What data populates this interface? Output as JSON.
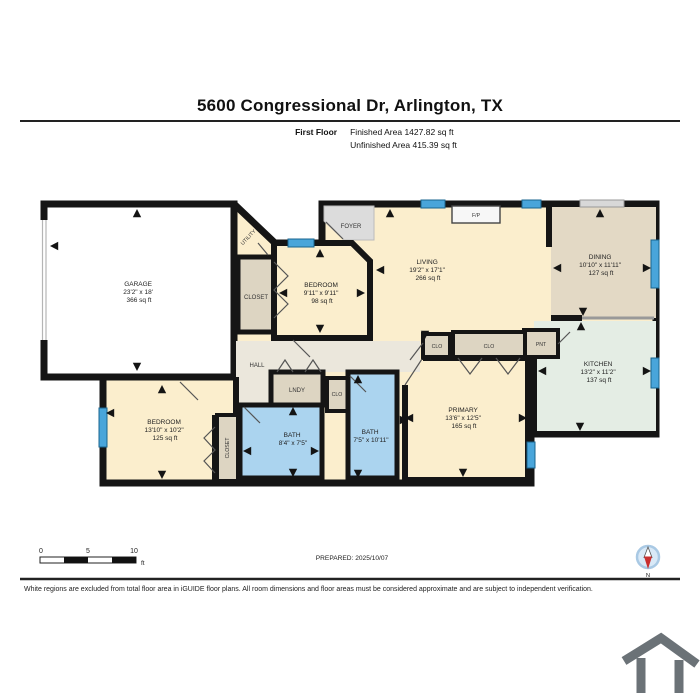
{
  "header": {
    "title": "5600 Congressional Dr, Arlington, TX",
    "floor_label": "First Floor",
    "finished_area": "Finished Area 1427.82 sq ft",
    "unfinished_area": "Unfinished Area 415.39 sq ft"
  },
  "plan": {
    "rooms": [
      {
        "name": "GARAGE",
        "dims": "23'2\" x 18'",
        "area": "366 sq ft"
      },
      {
        "name": "BEDROOM",
        "dims": "9'11\" x 9'11\"",
        "area": "98 sq ft"
      },
      {
        "name": "LIVING",
        "dims": "19'2\" x 17'1\"",
        "area": "266 sq ft"
      },
      {
        "name": "DINING",
        "dims": "10'10\" x 11'11\"",
        "area": "127 sq ft"
      },
      {
        "name": "KITCHEN",
        "dims": "13'2\" x 11'2\"",
        "area": "137 sq ft"
      },
      {
        "name": "BEDROOM",
        "dims": "13'10\" x 10'2\"",
        "area": "125 sq ft"
      },
      {
        "name": "BATH",
        "dims": "8'4\" x 7'5\"",
        "area": ""
      },
      {
        "name": "BATH",
        "dims": "7'5\" x 10'11\"",
        "area": ""
      },
      {
        "name": "PRIMARY",
        "dims": "13'6\" x 12'5\"",
        "area": "165 sq ft"
      }
    ],
    "labels": {
      "utility": "UTILITY",
      "foyer": "FOYER",
      "fireplace": "F/P",
      "closet_top": "CLOSET",
      "hall": "HALL",
      "laundry": "LNDY",
      "clo_small": "CLO",
      "clo_1": "CLO",
      "clo_2": "CLO",
      "pantry": "PNT",
      "closet_vertical": "CLOSET"
    }
  },
  "scale_bar": {
    "tick_0": "0",
    "tick_5": "5",
    "tick_10": "10",
    "unit": "ft"
  },
  "compass": {
    "north_label": "N"
  },
  "footer": {
    "prepared": "PREPARED: 2025/10/07",
    "disclaimer": "White regions are excluded from total floor area in iGUIDE floor plans. All room dimensions and floor areas must be considered approximate and are subject to independent verification."
  },
  "colors": {
    "cream_room": "#fbeecd",
    "tan_room": "#e3d9c5",
    "closet_tan": "#ddd5c2",
    "kitchen_mint": "#e4ede4",
    "bath_blue": "#abd4ef",
    "hall_gray": "#ebe7dc",
    "foyer_gray": "#dcdcdc",
    "window_blue": "#49a5da",
    "wall_black": "#151515",
    "compass_red": "#c92f2f",
    "logo_gray": "#6b7277"
  }
}
